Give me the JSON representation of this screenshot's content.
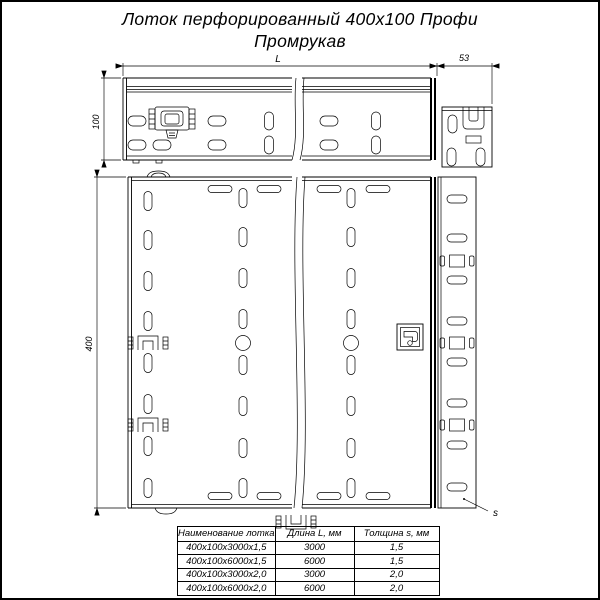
{
  "title": {
    "line1": "Лоток перфорированный 400x100 Профи",
    "line2": "Промрукав"
  },
  "dims": {
    "length": "L",
    "connector": "53",
    "height": "100",
    "width": "400",
    "thickness": "s"
  },
  "table": {
    "headers": [
      "Наименование лотка",
      "Длина L, мм",
      "Толщина s, мм"
    ],
    "rows": [
      [
        "400x100x3000x1,5",
        "3000",
        "1,5"
      ],
      [
        "400x100x6000x1,5",
        "6000",
        "1,5"
      ],
      [
        "400x100x3000x2,0",
        "3000",
        "2,0"
      ],
      [
        "400x100x6000x2,0",
        "6000",
        "2,0"
      ]
    ]
  },
  "colors": {
    "line": "#000000",
    "background": "#ffffff"
  }
}
